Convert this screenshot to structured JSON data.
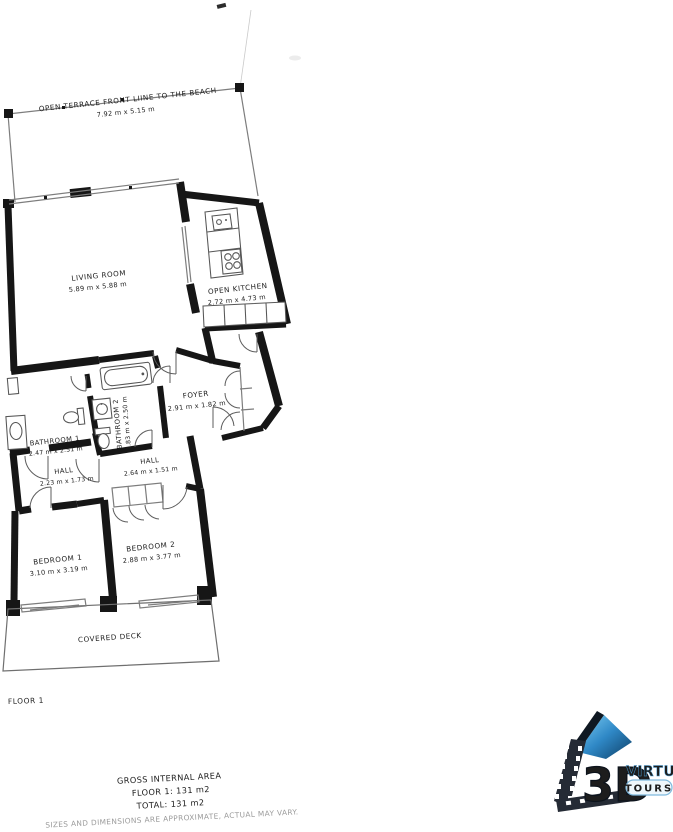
{
  "plan": {
    "floor_tag": "FLOOR 1",
    "labels": {
      "terrace_name": "OPEN TERRACE FRONT LIINE TO THE BEACH",
      "terrace_dims": "7.92 m x 5.15 m",
      "living_name": "LIVING ROOM",
      "living_dims": "5.89 m x 5.88 m",
      "kitchen_name": "OPEN KITCHEN",
      "kitchen_dims": "2.72 m x 4.73 m",
      "foyer_name": "FOYER",
      "foyer_dims": "2.91 m x 1.82 m",
      "bath1_name": "BATHROOM 1",
      "bath1_dims": "2.47 m x 2.51 m",
      "bath2_name": "BATHROOM 2",
      "bath2_dims": "1.83 m x 2.50 m",
      "hall1_name": "HALL",
      "hall1_dims": "2.23 m x 1.73 m",
      "hall2_name": "HALL",
      "hall2_dims": "2.64 m x 1.51 m",
      "bed1_name": "BEDROOM 1",
      "bed1_dims": "3.10 m x 3.19 m",
      "bed2_name": "BEDROOM 2",
      "bed2_dims": "2.88 m x 3.77 m",
      "deck_name": "COVERED DECK"
    },
    "summary": {
      "title": "GROSS INTERNAL AREA",
      "floor_line": "FLOOR 1: 131 m2",
      "total_line": "TOTAL: 131 m2"
    },
    "disclaimer": "SIZES AND DIMENSIONS ARE APPROXIMATE, ACTUAL MAY VARY.",
    "colors": {
      "wall": "#161616",
      "thin_line": "#7d7d7d",
      "fixture": "#565656",
      "text": "#1c1c1c",
      "muted": "#9b9b9b",
      "logo_blue": "#2f88c6",
      "logo_dark": "#19212e"
    }
  },
  "logo": {
    "big": "3D",
    "word_top": "VIRTUAL",
    "word_bottom": "TOURS"
  }
}
